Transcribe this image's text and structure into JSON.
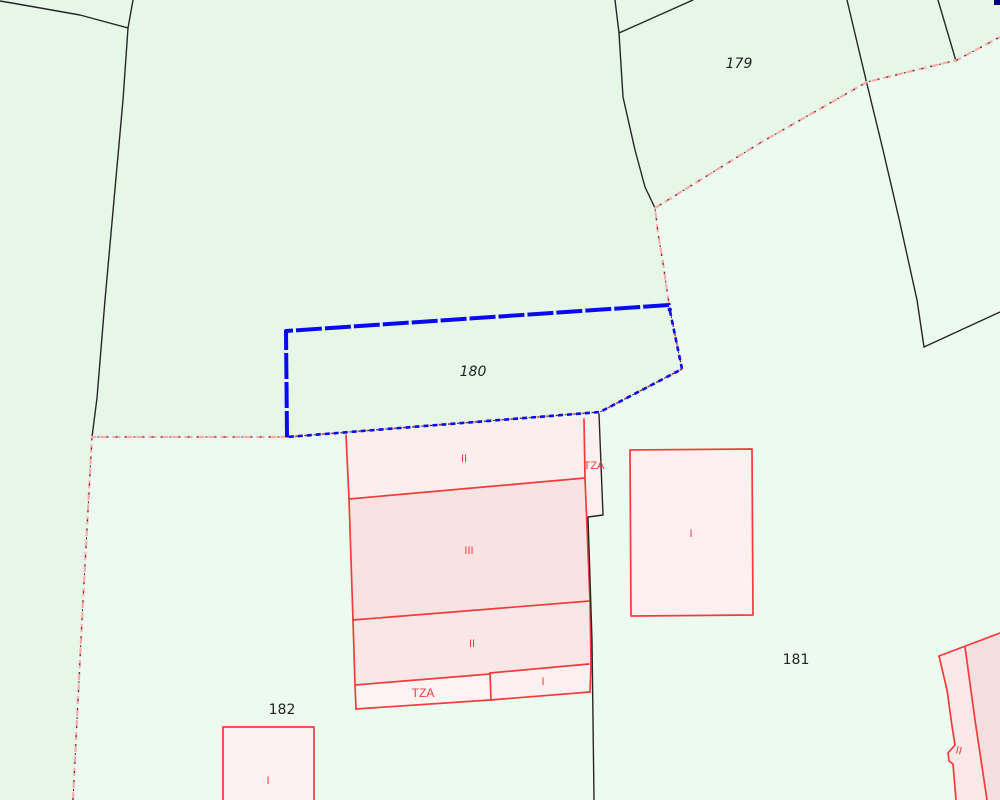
{
  "map": {
    "parcels": [
      {
        "id": "179",
        "label": "179"
      },
      {
        "id": "180",
        "label": "180",
        "selected": true
      },
      {
        "id": "181",
        "label": "181"
      },
      {
        "id": "182",
        "label": "182"
      }
    ],
    "buildings": {
      "main": {
        "floor_labels": [
          "II",
          "III",
          "II",
          "TZA",
          "I"
        ],
        "terrace_label": "TZA"
      },
      "right": {
        "label": "I"
      },
      "bottom_left": {
        "label": "I"
      },
      "bottom_right": {
        "label": "II"
      }
    },
    "colors": {
      "background": "#edfaef",
      "background_upper": "#e6f7e7",
      "selection_blue": "#0a0af0",
      "boundary_pink": "#ffaaaa",
      "building_red": "#f23b3b",
      "parcel_line_black": "#262626",
      "building_fill_light": "#fdeeee",
      "building_fill_mid": "#f9e6e6",
      "building_fill_dark": "#f8e2e2",
      "building_fill_terrace": "#fdf3f3",
      "building_fill_plain": "#fdf0f0",
      "corner_mark_navy": "#000080"
    }
  }
}
